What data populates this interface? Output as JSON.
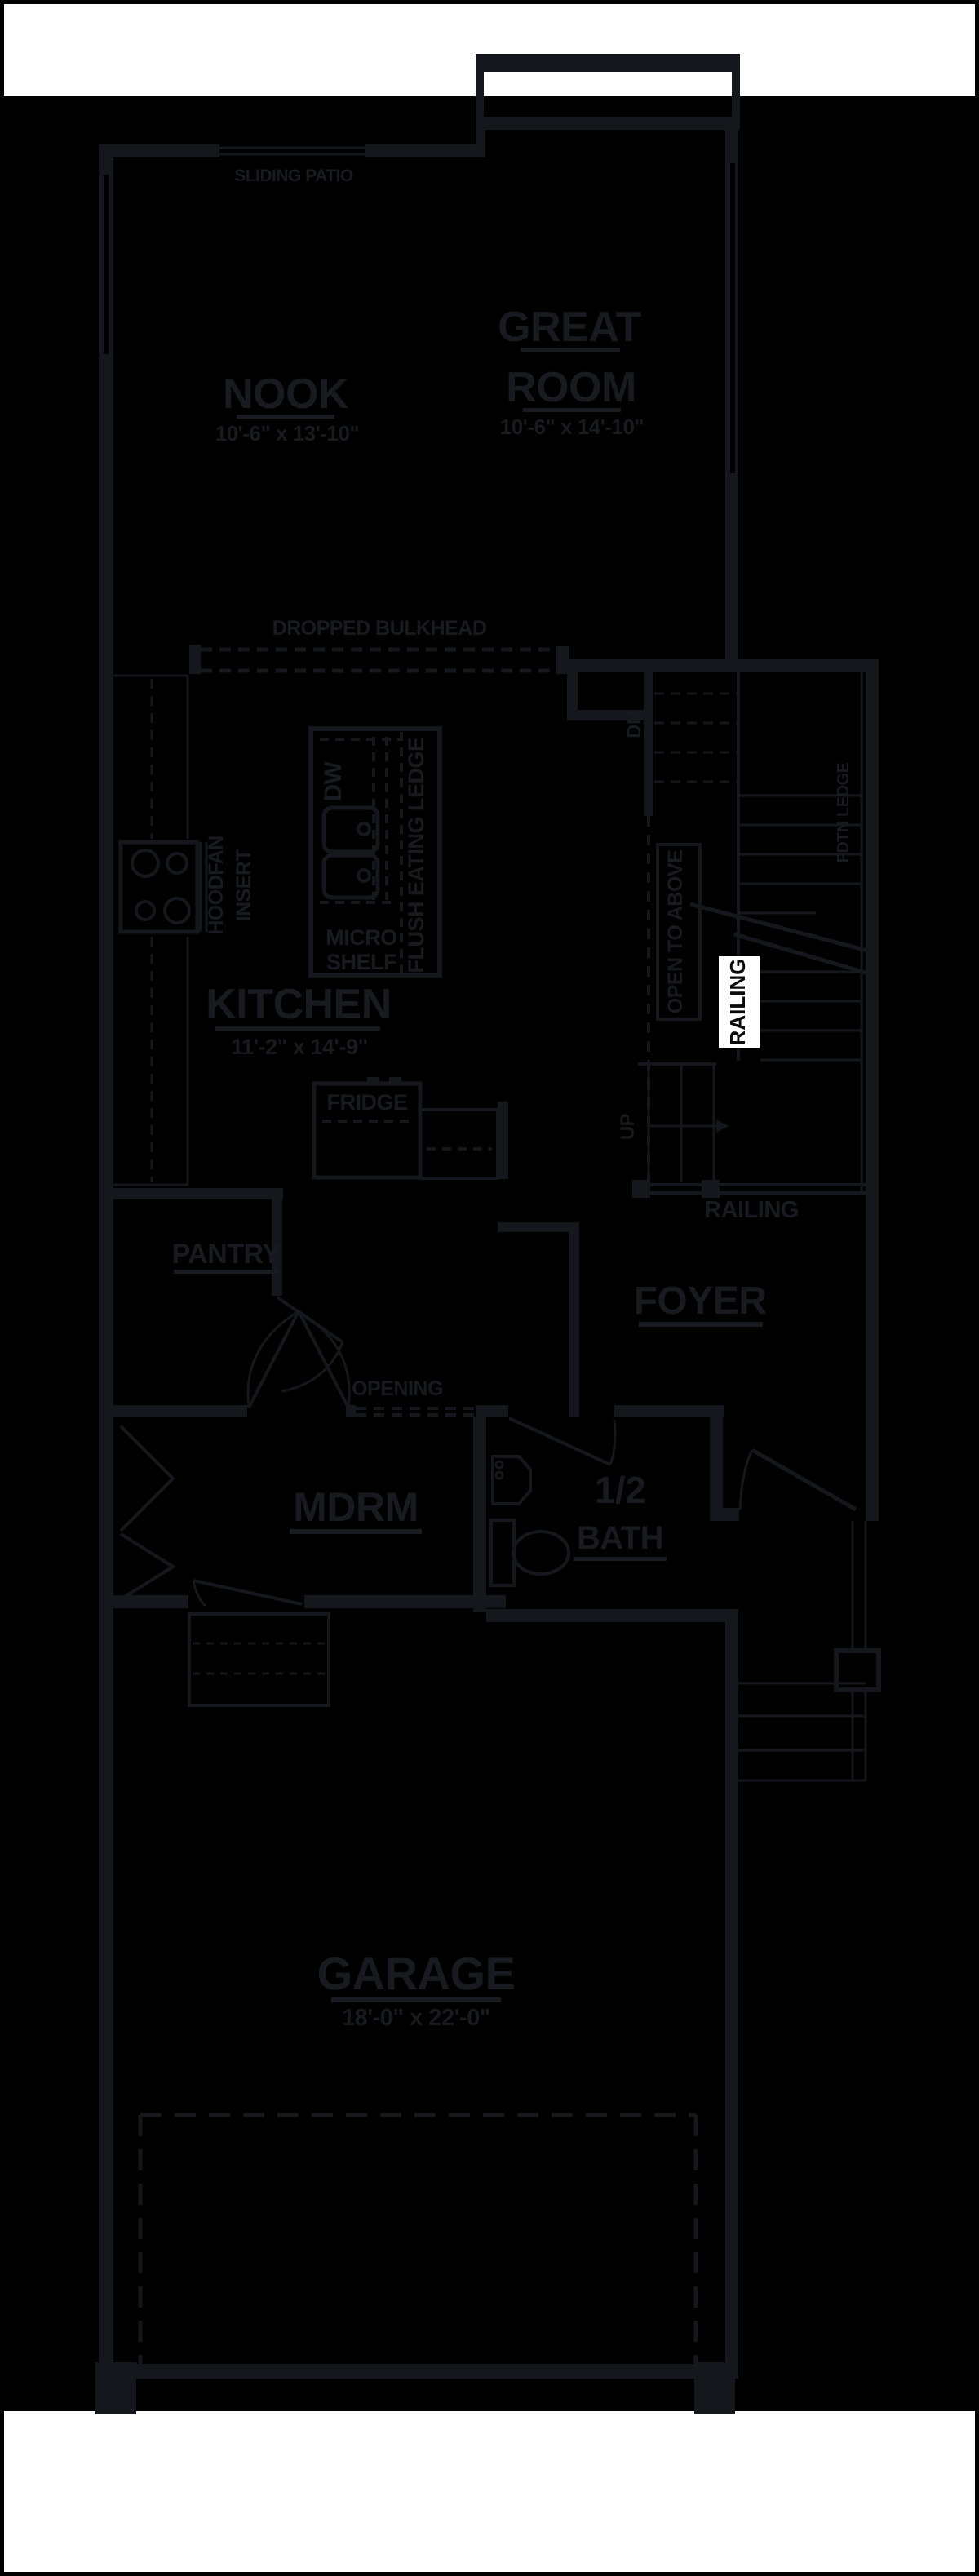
{
  "colors": {
    "page_bg": "#ffffff",
    "canvas_bg": "#000000",
    "ink": "#171b20",
    "wall": "#14181c",
    "highlight_bg": "#ffffff",
    "highlight_text": "#0a0a0a"
  },
  "plan": {
    "rooms": {
      "nook": {
        "name": "NOOK",
        "dims": "10'-6\" x 13'-10\""
      },
      "great_room": {
        "line1": "GREAT",
        "line2": "ROOM",
        "dims": "10'-6\" x 14'-10\""
      },
      "kitchen": {
        "name": "KITCHEN",
        "dims": "11'-2\" x 14'-9\""
      },
      "pantry": {
        "name": "PANTRY"
      },
      "foyer": {
        "name": "FOYER"
      },
      "mudroom": {
        "name": "MDRM"
      },
      "half_bath": {
        "line1": "1/2",
        "line2": "BATH"
      },
      "garage": {
        "name": "GARAGE",
        "dims": "18'-0\" x 22'-0\""
      }
    },
    "labels": {
      "sliding_patio": "SLIDING PATIO",
      "dropped_bulkhead": "DROPPED BULKHEAD",
      "hoodfan_line1": "HOODFAN",
      "hoodfan_line2": "INSERT",
      "dishwasher": "DW",
      "micro_shelf_line1": "MICRO",
      "micro_shelf_line2": "SHELF",
      "flush_eating_ledge": "FLUSH EATING LEDGE",
      "fridge": "FRIDGE",
      "stairs_down": "DN",
      "stairs_up": "UP",
      "open_to_above": "OPEN TO ABOVE",
      "foundation_ledge": "FDTN LEDGE",
      "railing_stairwell": "RAILING",
      "railing_foyer": "RAILING",
      "opening": "OPENING"
    }
  }
}
